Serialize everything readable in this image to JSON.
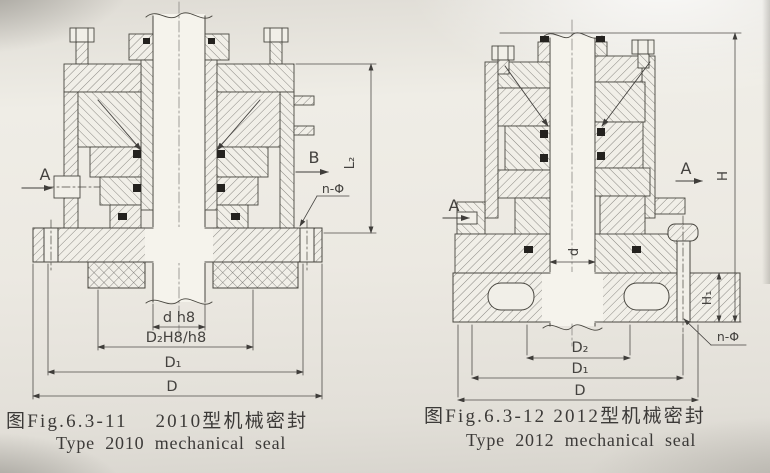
{
  "page": {
    "paper_color": "#eceae3",
    "ink_color": "#44423f"
  },
  "figure_2010": {
    "labels": {
      "section_a": "A",
      "section_b": "B",
      "bolt_holes": "n-Φ",
      "height": "L₂",
      "shaft_fit": "d h8",
      "seat_fit": "D₂H8/h8",
      "bolt_circle_dia": "D₁",
      "flange_dia": "D"
    },
    "caption_zh": "图Fig.6.3-11    2010型机械密封",
    "caption_en": "Type 2010 mechanical seal"
  },
  "figure_2012": {
    "labels": {
      "section_a_left": "A",
      "section_a_right": "A",
      "bolt_holes": "n-Φ",
      "total_height": "H",
      "flange_height": "H₁",
      "shaft_dia": "d",
      "seat_dia": "D₂",
      "bolt_circle_dia": "D₁",
      "flange_dia": "D"
    },
    "caption_zh": "图Fig.6.3-12 2012型机械密封",
    "caption_en": "Type 2012 mechanical seal"
  }
}
